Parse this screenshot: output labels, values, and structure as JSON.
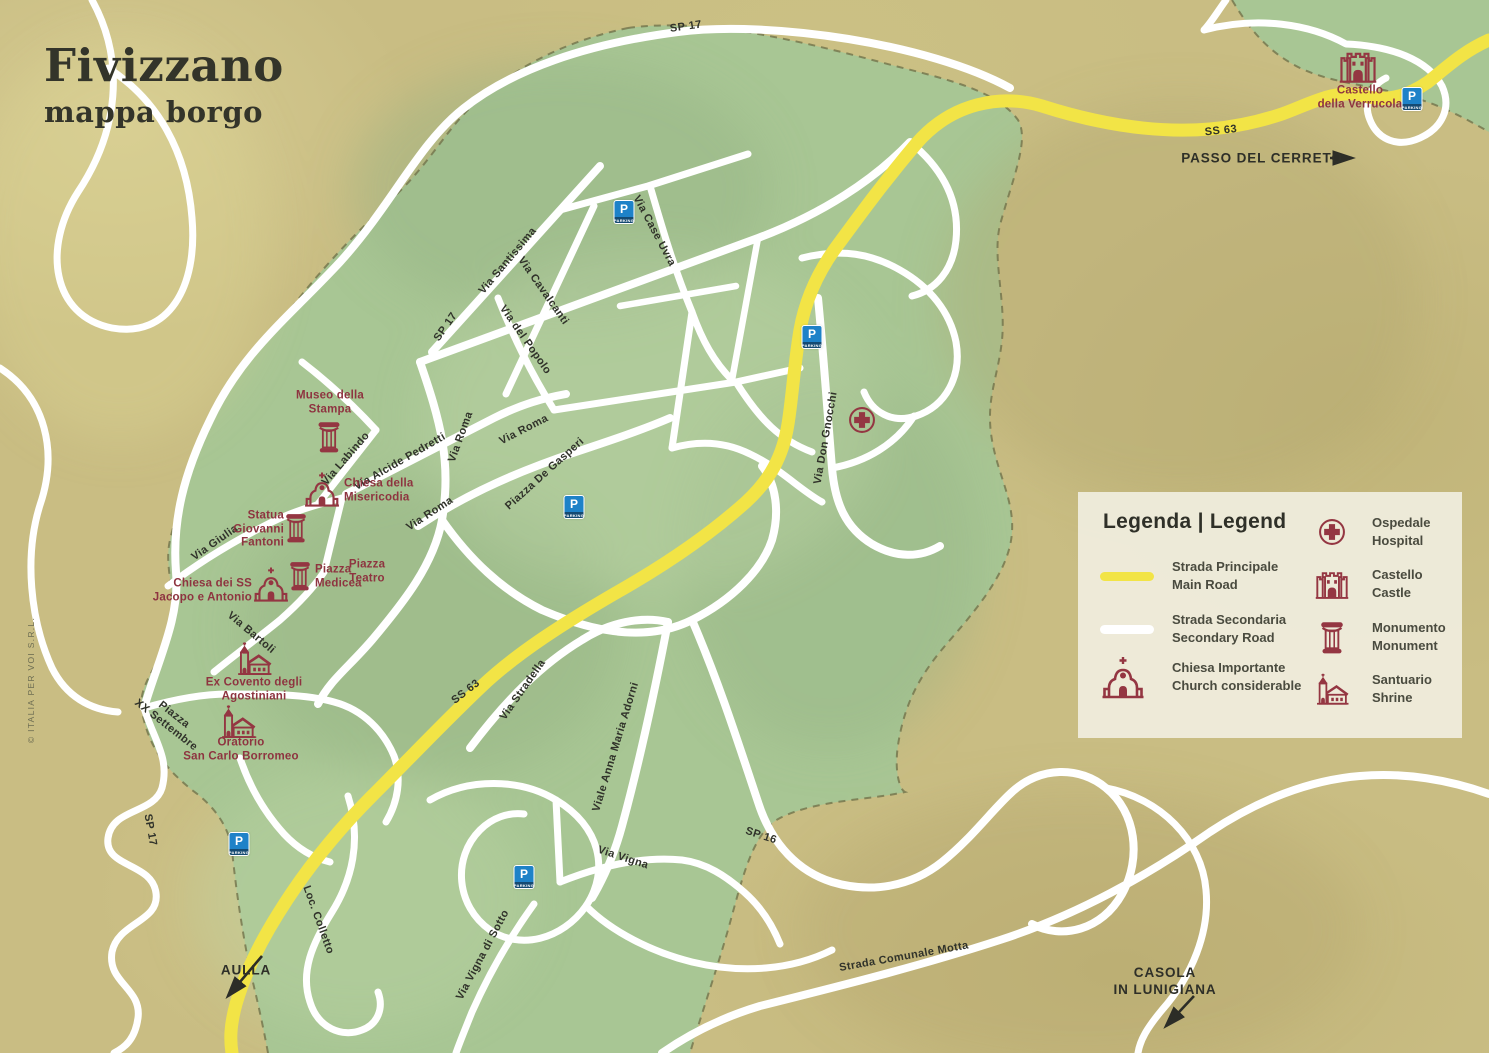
{
  "title": {
    "main": "Fivizzano",
    "subtitle": "mappa borgo"
  },
  "copyright": "© ITALIA PER VOI S.R.L.",
  "colors": {
    "background": "#c9bd83",
    "urban_area": "#a8c694",
    "main_road": "#f2e446",
    "secondary_road": "#ffffff",
    "poi_accent": "#943642",
    "parking_blue": "#1e82c8",
    "legend_bg": "#eeebdb",
    "text_dark": "#30322a"
  },
  "legend": {
    "heading": "Legenda | Legend",
    "road_items": [
      {
        "swatch": "main-road",
        "line1": "Strada Principale",
        "line2": "Main Road"
      },
      {
        "swatch": "sec-road",
        "line1": "Strada Secondaria",
        "line2": "Secondary Road"
      },
      {
        "icon": "church",
        "line1": "Chiesa Importante",
        "line2": "Church considerable"
      }
    ],
    "poi_items": [
      {
        "icon": "hospital",
        "line1": "Ospedale",
        "line2": "Hospital"
      },
      {
        "icon": "castle",
        "line1": "Castello",
        "line2": "Castle"
      },
      {
        "icon": "monument",
        "line1": "Monumento",
        "line2": "Monument"
      },
      {
        "icon": "shrine",
        "line1": "Santuario",
        "line2": "Shrine"
      }
    ]
  },
  "map": {
    "street_labels": [
      {
        "text": "SP 17",
        "x": 686,
        "y": 27,
        "rot": -8,
        "cls": "roadnum"
      },
      {
        "text": "SS 63",
        "x": 1221,
        "y": 131,
        "rot": -6,
        "cls": "roadnum"
      },
      {
        "text": "Via Case Uvra",
        "x": 654,
        "y": 231,
        "rot": 62
      },
      {
        "text": "Via Santissima",
        "x": 508,
        "y": 261,
        "rot": -50
      },
      {
        "text": "Via Cavalcanti",
        "x": 543,
        "y": 291,
        "rot": 55
      },
      {
        "text": "Via del Popolo",
        "x": 525,
        "y": 340,
        "rot": 55
      },
      {
        "text": "SP 17",
        "x": 446,
        "y": 327,
        "rot": -55,
        "cls": "roadnum"
      },
      {
        "text": "Via Labindo",
        "x": 346,
        "y": 459,
        "rot": -49
      },
      {
        "text": "Via Alcide Pedretti",
        "x": 400,
        "y": 462,
        "rot": -30
      },
      {
        "text": "Via Roma",
        "x": 461,
        "y": 437,
        "rot": -70
      },
      {
        "text": "Via Roma",
        "x": 524,
        "y": 430,
        "rot": -27
      },
      {
        "text": "Via Roma",
        "x": 430,
        "y": 514,
        "rot": -33
      },
      {
        "text": "Piazza De Gasperi",
        "x": 545,
        "y": 474,
        "rot": -42
      },
      {
        "text": "Via Giulia",
        "x": 215,
        "y": 543,
        "rot": -35
      },
      {
        "text": "Via Bartoli",
        "x": 251,
        "y": 633,
        "rot": 40
      },
      {
        "text": "Piazza\nXX Settembre",
        "x": 170,
        "y": 720,
        "rot": 38
      },
      {
        "text": "Via Don Gnocchi",
        "x": 826,
        "y": 438,
        "rot": -80
      },
      {
        "text": "SS 63",
        "x": 466,
        "y": 692,
        "rot": -38,
        "cls": "roadnum"
      },
      {
        "text": "SP 17",
        "x": 150,
        "y": 830,
        "rot": 80,
        "cls": "roadnum"
      },
      {
        "text": "Loc. Colletto",
        "x": 318,
        "y": 920,
        "rot": 70
      },
      {
        "text": "Via Stradella",
        "x": 523,
        "y": 690,
        "rot": -55
      },
      {
        "text": "Viale Anna Maria Adorni",
        "x": 616,
        "y": 747,
        "rot": -73
      },
      {
        "text": "Via Vigna",
        "x": 623,
        "y": 858,
        "rot": 18
      },
      {
        "text": "Via Vigna di Sotto",
        "x": 483,
        "y": 955,
        "rot": -62
      },
      {
        "text": "SP 16",
        "x": 761,
        "y": 836,
        "rot": 18,
        "cls": "roadnum"
      },
      {
        "text": "Strada Comunale Motta",
        "x": 904,
        "y": 957,
        "rot": -10
      }
    ],
    "poi_labels": [
      {
        "text": "Museo della\nStampa",
        "x": 330,
        "y": 403,
        "align": "center"
      },
      {
        "text": "Chiesa della\nMisericodia",
        "x": 344,
        "y": 491,
        "align": "left"
      },
      {
        "text": "Statua\nGiovanni\nFantoni",
        "x": 284,
        "y": 530,
        "align": "right"
      },
      {
        "text": "Piazza\nMedicea",
        "x": 315,
        "y": 577,
        "align": "left"
      },
      {
        "text": "Piazza\nTeatro",
        "x": 367,
        "y": 572,
        "align": "center"
      },
      {
        "text": "Chiesa dei SS\nJacopo e Antonio",
        "x": 252,
        "y": 591,
        "align": "right"
      },
      {
        "text": "Ex Covento degli\nAgostiniani",
        "x": 254,
        "y": 690,
        "align": "center"
      },
      {
        "text": "Oratorio\nSan Carlo Borromeo",
        "x": 241,
        "y": 750,
        "align": "center"
      },
      {
        "text": "Castello\ndella Verrucola",
        "x": 1360,
        "y": 98,
        "align": "center"
      }
    ],
    "poi_icons": [
      {
        "icon": "monument",
        "x": 329,
        "y": 437,
        "s": 32
      },
      {
        "icon": "church",
        "x": 322,
        "y": 489,
        "s": 38
      },
      {
        "icon": "monument",
        "x": 296,
        "y": 528,
        "s": 30
      },
      {
        "icon": "monument",
        "x": 300,
        "y": 576,
        "s": 30
      },
      {
        "icon": "church",
        "x": 271,
        "y": 584,
        "s": 38
      },
      {
        "icon": "shrine",
        "x": 254,
        "y": 659,
        "s": 38
      },
      {
        "icon": "shrine",
        "x": 238,
        "y": 722,
        "s": 38
      },
      {
        "icon": "castle",
        "x": 1358,
        "y": 66,
        "s": 40
      },
      {
        "icon": "hospital",
        "x": 862,
        "y": 420,
        "s": 30
      }
    ],
    "parking": {
      "letter": "P",
      "caption": "PARKING",
      "positions": [
        {
          "x": 624,
          "y": 212
        },
        {
          "x": 812,
          "y": 337
        },
        {
          "x": 574,
          "y": 507
        },
        {
          "x": 239,
          "y": 844
        },
        {
          "x": 524,
          "y": 877
        },
        {
          "x": 1412,
          "y": 99
        }
      ]
    },
    "directions": [
      {
        "text": "PASSO DEL CERRETO",
        "x": 1262,
        "y": 159
      },
      {
        "text": "AULLA",
        "x": 246,
        "y": 971
      },
      {
        "text": "CASOLA\nIN LUNIGIANA",
        "x": 1165,
        "y": 982
      }
    ]
  }
}
